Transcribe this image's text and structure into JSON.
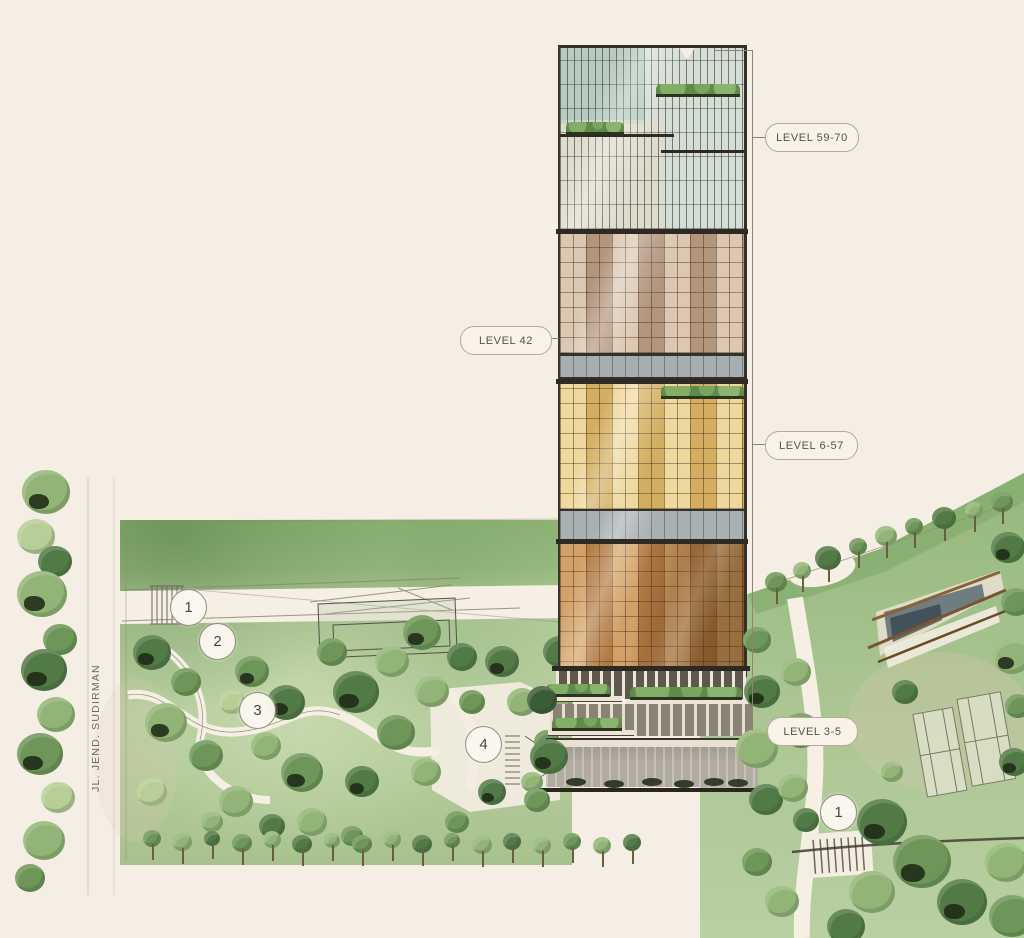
{
  "illustration": {
    "street_label": "JL. JEND. SUDIRMAN",
    "callouts": [
      {
        "id": "level-59-70",
        "text": "LEVEL 59-70"
      },
      {
        "id": "level-42",
        "text": "LEVEL 42"
      },
      {
        "id": "level-6-57",
        "text": "LEVEL 6-57"
      },
      {
        "id": "level-3-5",
        "text": "LEVEL 3-5"
      }
    ],
    "markers": [
      {
        "number": "1"
      },
      {
        "number": "2"
      },
      {
        "number": "3"
      },
      {
        "number": "4"
      },
      {
        "number": "1"
      }
    ],
    "palette": {
      "background": "#f5eee5",
      "lawn_light": "#b5cd9c",
      "lawn_mid": "#93b87b",
      "tree_dark": "#4f7345",
      "tower_glass": "#d5ded4",
      "tower_taupe": "#bfa58c",
      "tower_gold": "#e0c175",
      "tower_copper": "#c58f52",
      "band_gray": "#a6aeb2",
      "ink": "#2e2a23",
      "callout_border": "#b7a996",
      "callout_text": "#57524a"
    }
  }
}
